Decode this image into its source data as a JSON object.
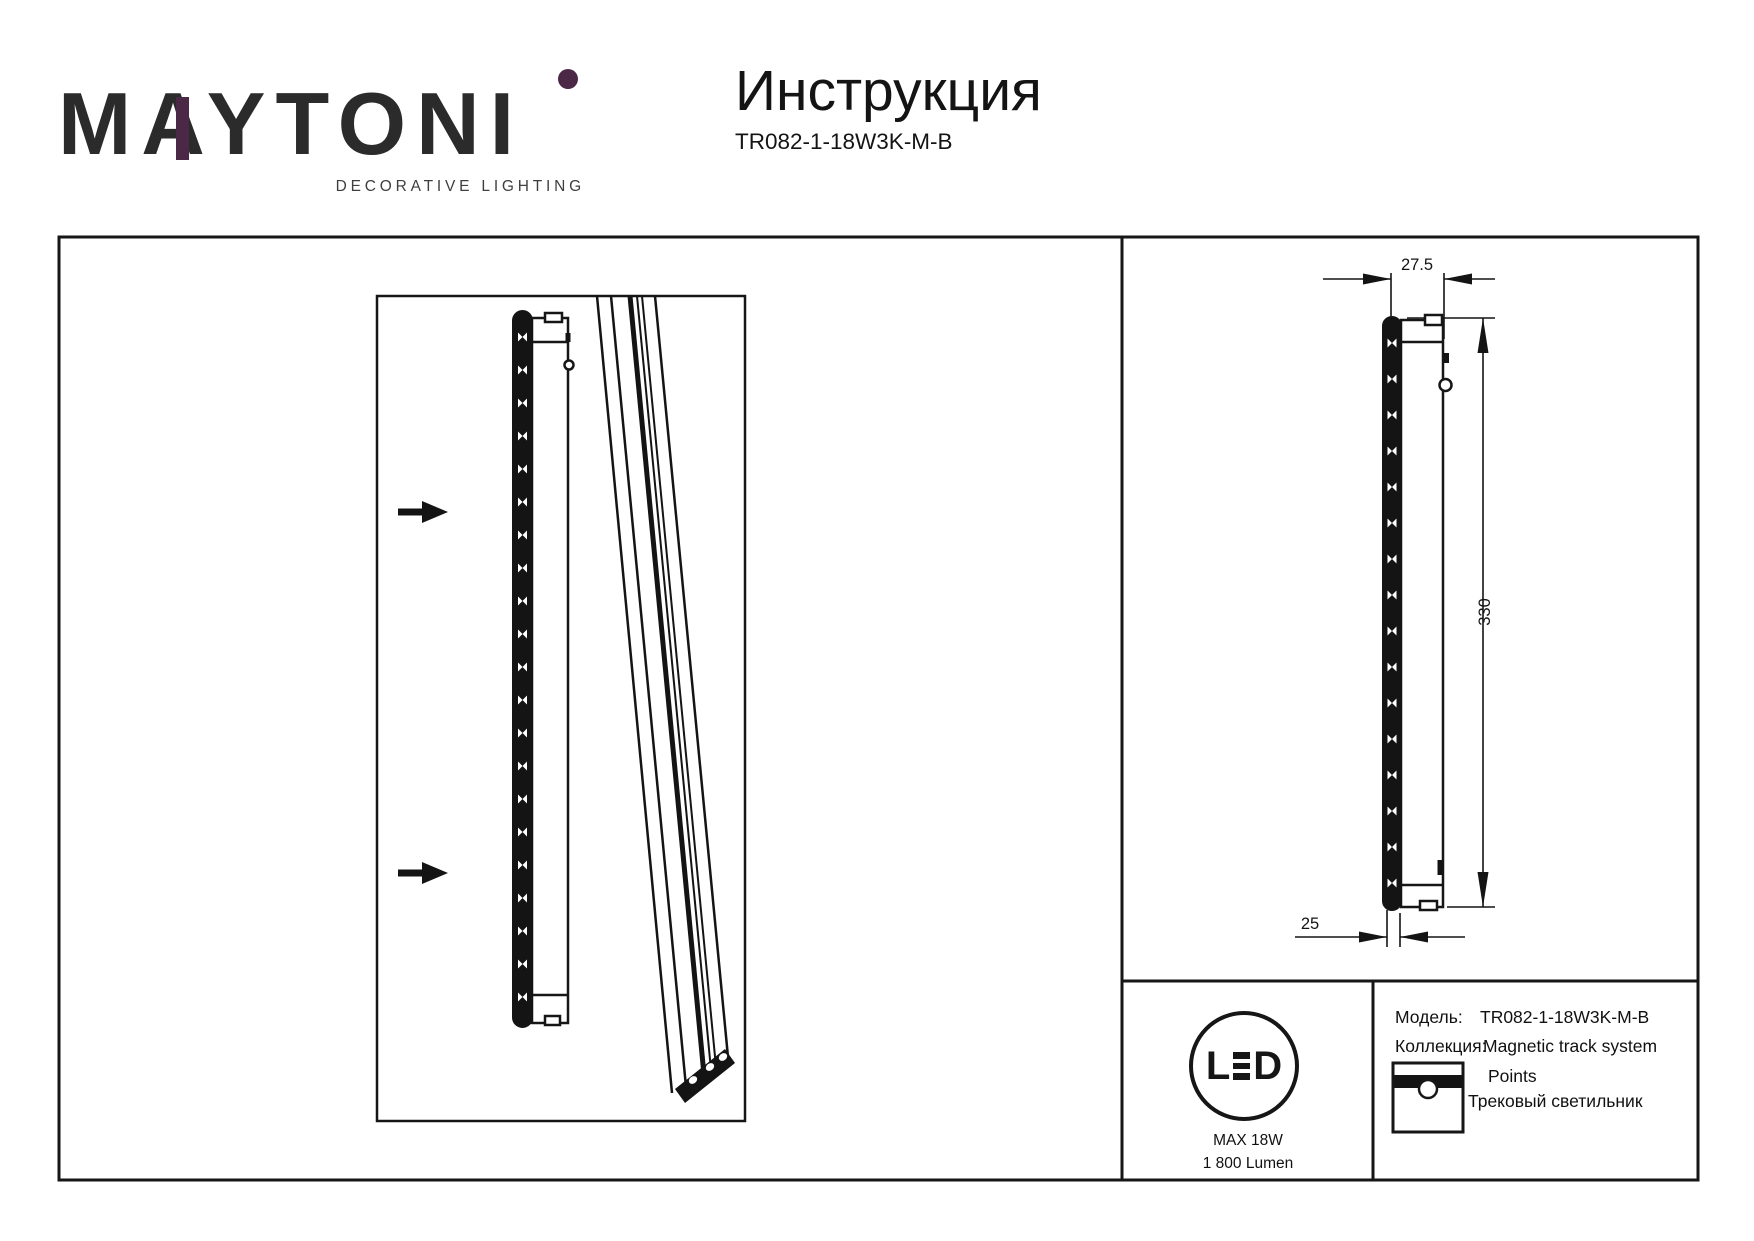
{
  "colors": {
    "ink": "#161616",
    "accent_purple": "#4b2846"
  },
  "logo": {
    "wordmark": "MAYTONI",
    "tagline": "DECORATIVE LIGHTING"
  },
  "header": {
    "title": "Инструкция",
    "model_code": "TR082-1-18W3K-M-B"
  },
  "drawing": {
    "dim_width": "27.5",
    "dim_height": "330",
    "dim_depth": "25"
  },
  "badge": {
    "led_left": "L",
    "led_right": "D",
    "max_power": "MAX 18W",
    "luminous_flux": "1 800 Lumen"
  },
  "specs": {
    "model_label": "Модель:",
    "model_value": "TR082-1-18W3K-M-B",
    "collection_label": "Коллекция:",
    "collection_value": "Magnetic track system",
    "series_value": "Points",
    "type_value": "Трековый светильник"
  }
}
